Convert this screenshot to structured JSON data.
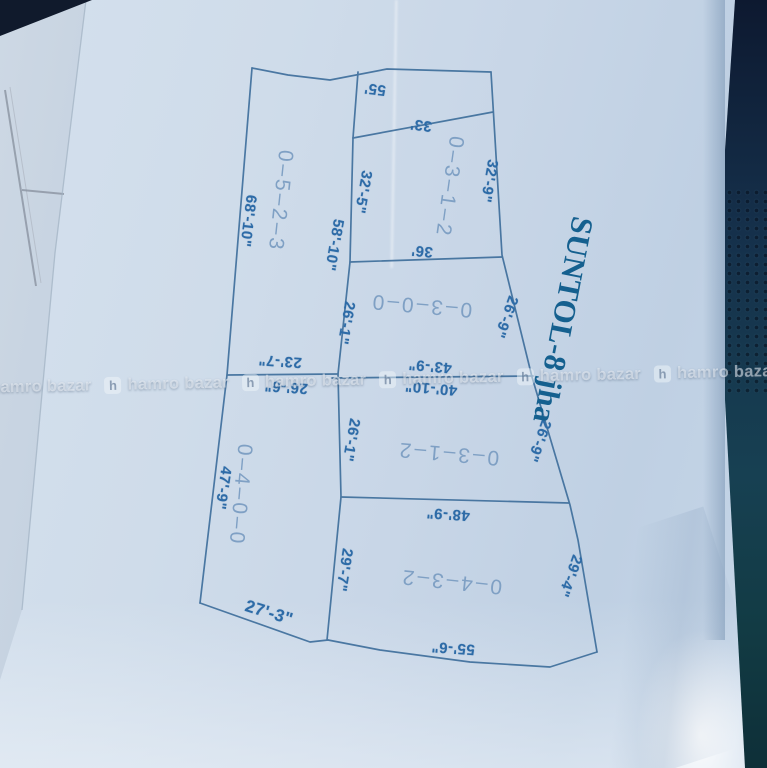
{
  "map": {
    "title": "SUNTOL-8 jha",
    "plot_numbers": {
      "top": "0–3–1–2",
      "left_upper": "0–5–2–3",
      "middle": "0–3–0–0",
      "center": "0–3–1–2",
      "left_lower": "0–4–0–0",
      "bottom": "0–4–3–2"
    },
    "dimensions": {
      "top_edge": "55'",
      "strip_bottom": "33'",
      "p1_right": "32'-9\"",
      "p1_left": "32'-5\"",
      "p2_right_upper": "58'-10\"",
      "p1_bottom": "36'",
      "p3_right": "26'-9\"",
      "p3_left": "26'-1\"",
      "p3_bottom": "43'-9\"",
      "p4_top": "40'-10\"",
      "p2_bottom": "23'-7\"",
      "p5_top": "26'-6\"",
      "p4_left": "26'-1\"",
      "p4_right": "26'-9\"",
      "p4_bottom": "48'-9\"",
      "p2_left": "68'-10\"",
      "p5_left": "47'-9\"",
      "p5_bottom": "27'-3\"",
      "p6_left": "29'-7\"",
      "p6_right": "29'-4\"",
      "p6_bottom": "55'-6\""
    }
  },
  "watermark": {
    "brand": "hamro bazar",
    "logo_glyph": "h"
  },
  "colors": {
    "dimension_ink": "#2d6ba7",
    "plot_number_ink": "#7fa0c4",
    "title_ink": "#15608f",
    "boundary_line": "#3f6f9c",
    "paper": "#c8d6e7",
    "dark_edge": "#15304b"
  }
}
